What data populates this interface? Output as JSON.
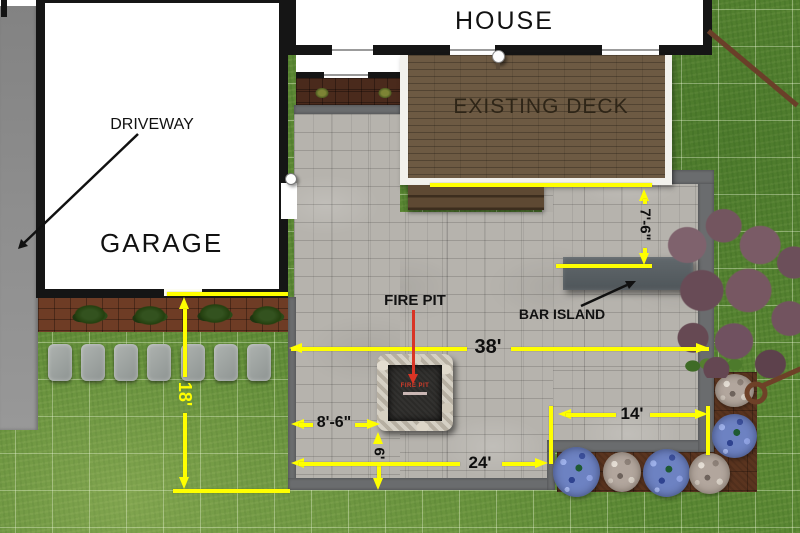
{
  "plan": {
    "title_note": "backyard patio landscape plan",
    "areas": {
      "house": "HOUSE",
      "existing_deck": "EXISTING DECK",
      "driveway": "DRIVEWAY",
      "garage": "GARAGE"
    },
    "features": {
      "fire_pit_label": "FIRE PIT",
      "bar_island_label": "BAR ISLAND",
      "fire_pit_unit_text": "FIRE PIT"
    },
    "dimensions": {
      "patio_width": "38'",
      "left_side_depth": "18'",
      "fire_pit_offset": "8'-6\"",
      "lower_patio_width": "24'",
      "right_patio_width": "14'",
      "deck_to_island": "7'-6\"",
      "fire_pit_to_edge": "6'"
    },
    "colors": {
      "dimension_yellow": "#ffff00",
      "callout_red": "#d93425",
      "label_black": "#111111",
      "grass_green": "#5a8733",
      "paver_gray": "#b6b3ad",
      "patio_border_gray": "#6a6c6e",
      "deck_brown": "#6d5a43",
      "mulch_brown": "#6e3c25",
      "tree_purple": "#7a5662",
      "flower_blue": "#6d82c2"
    }
  }
}
